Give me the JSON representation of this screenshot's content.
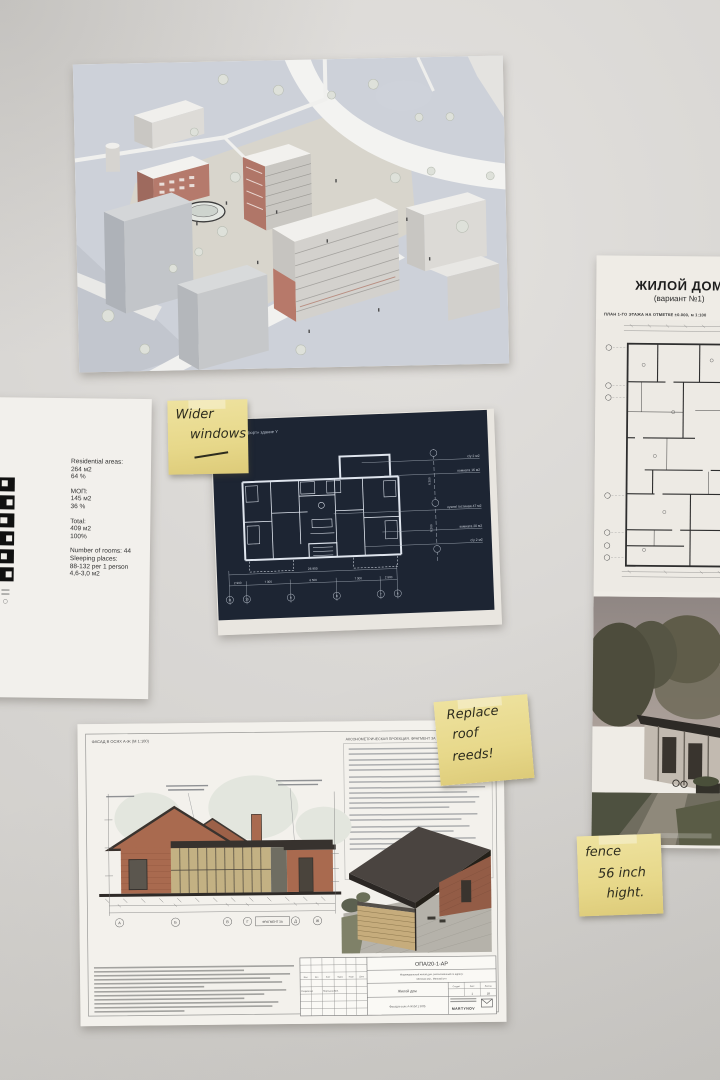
{
  "colors": {
    "wall": "#d8d6d3",
    "blueprint_navy": "#1d2533",
    "sticky_yellow": "#e7d88a",
    "brick": "#a96a4f"
  },
  "left_doc": {
    "blocks": [
      [
        "Residential areas:",
        "264 м2",
        "64 %"
      ],
      [
        "МОП:",
        "145 м2",
        "36 %"
      ],
      [
        "Total:",
        "409 м2",
        "100%"
      ],
      [
        "Number of rooms: 44",
        "Sleeping places:",
        "88-132 per 1 person",
        "4,6-3,0 м2"
      ]
    ]
  },
  "right_doc": {
    "title": "ЖИЛОЙ ДОМ",
    "subtitle": "(вариант №1)",
    "caption": "ПЛАН 1-ГО ЭТАЖА НА ОТМЕТКЕ ±0.000, м 1:100"
  },
  "blueprint": {
    "title": "…га «комфорт» здание Y",
    "rooms": [
      "с/у 2 м2",
      "комната 16 м2",
      "кухня/ гостиная 47 м2",
      "комната 20 м2",
      "с/у 2 м2"
    ],
    "total": "26 900",
    "dims": [
      "2 900",
      "7 300",
      "6 500",
      "7 300",
      "2 900"
    ],
    "vdims": [
      "6 200",
      "6 200"
    ],
    "grid": [
      "11",
      "10",
      "9",
      "8",
      "7",
      "6"
    ]
  },
  "stickies": {
    "note1": [
      "Wider",
      "windows"
    ],
    "note2": [
      "Replace",
      "roof",
      "reeds!"
    ],
    "note3": [
      "fence",
      "56 inch",
      "hight."
    ]
  },
  "drawing": {
    "caption_left": "ФАСАД В ОСЯХ А-Ж (М 1:100)",
    "caption_right": "АКСОНОМЕТРИЧЕСКАЯ ПРОЕКЦИЯ. ФРАГМЕНТ 3А",
    "grid": [
      "А",
      "Б",
      "В",
      "Г",
      "Д",
      "Ж"
    ],
    "fragment": "ФРАГМЕНТ 3А",
    "titleblock": {
      "code": "ОПА/20-1-АР",
      "project1": "Индивидуальный жилой дом, расположенный по адресу:",
      "project2": "Минская обл., Минский р-н",
      "object": "Жилой дом",
      "sheet": "Фасад в осях А-Ж (М 1:100)",
      "cols": [
        "Изм",
        "Кол",
        "Лист",
        "№док",
        "Подп",
        "Дата"
      ],
      "role": "Разработал",
      "role_name": "Мартынов М.В.",
      "stage_headers": [
        "Стадия",
        "Лист",
        "Листов"
      ],
      "stage_values": [
        "",
        "1",
        "18"
      ],
      "logo": "MARTYNOV"
    }
  }
}
